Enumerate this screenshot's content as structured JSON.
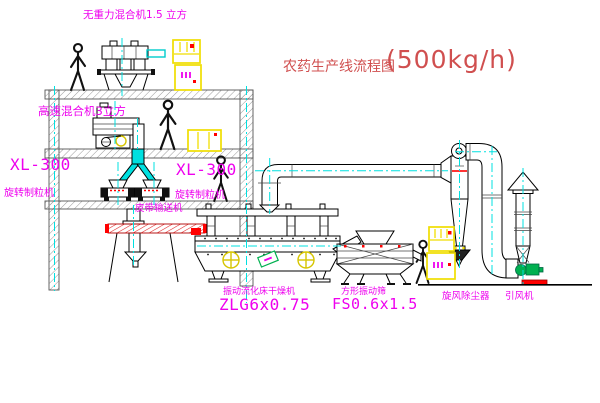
{
  "page": {
    "width": 600,
    "height": 403,
    "background": "#ffffff"
  },
  "title": {
    "prefix": "农药生产线流程图",
    "capacity": "(500kg/h)"
  },
  "labels": {
    "top_mixer": "无重力混合机1.5 立方",
    "floor2_mixer": "高速混合机3立方",
    "granulator_left_model": "XL-300",
    "granulator_left_name": "旋转制粒机",
    "granulator_right_model": "XL-300",
    "granulator_right_name": "旋转制粒机",
    "belt_conveyor": "皮带输送机",
    "dryer_name": "振动流化床干燥机",
    "dryer_model": "ZLG6x0.75",
    "sieve_name": "方形振动筛",
    "sieve_model": "FS0.6x1.5",
    "cyclone": "旋风除尘器",
    "fan": "引风机"
  },
  "colors": {
    "label-magenta": "#ee00ee",
    "title-red": "#d04f4f",
    "accent-red": "#ff0000",
    "centerline-cyan": "#00e0e0",
    "cabinet-yellow": "#f0de00",
    "fan-green": "#00b050",
    "line-black": "#000000",
    "hatch-gray": "#9a9a9a"
  }
}
